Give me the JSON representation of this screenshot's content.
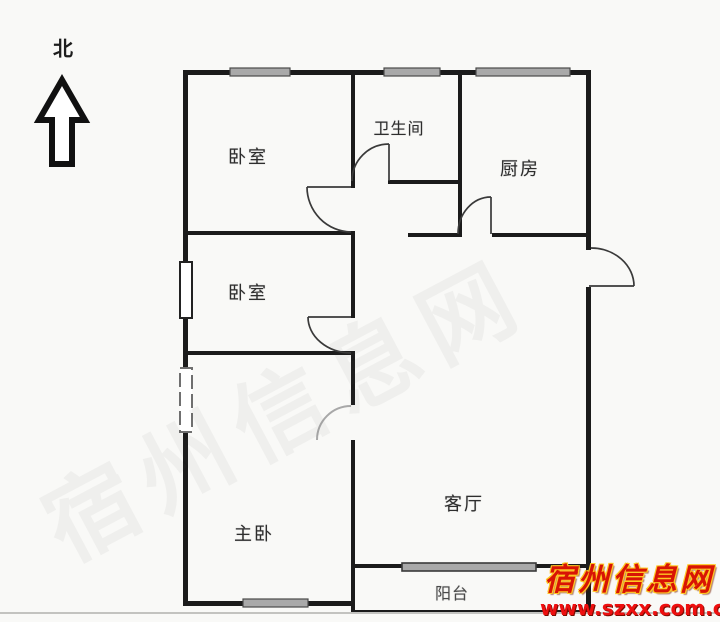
{
  "compass": {
    "label": "北"
  },
  "rooms": [
    {
      "id": "bedroom-top",
      "label": "卧室"
    },
    {
      "id": "bathroom",
      "label": "卫生间"
    },
    {
      "id": "kitchen",
      "label": "厨房"
    },
    {
      "id": "bedroom-middle",
      "label": "卧室"
    },
    {
      "id": "master-bedroom",
      "label": "主卧"
    },
    {
      "id": "living-room",
      "label": "客厅"
    },
    {
      "id": "balcony",
      "label": "阳台"
    }
  ],
  "watermark": {
    "site_name": "宿州信息网",
    "site_url": "www.szxx.com.cn",
    "ghost_text": "宿州信息网"
  },
  "colors": {
    "wall": "#1b1b1b",
    "window_fill": "#a9a9a9",
    "door_arc": "#3a3a3a",
    "watermark_red": "#d81405",
    "watermark_yellow": "#ffc823",
    "url_red": "#ee0f0f"
  }
}
